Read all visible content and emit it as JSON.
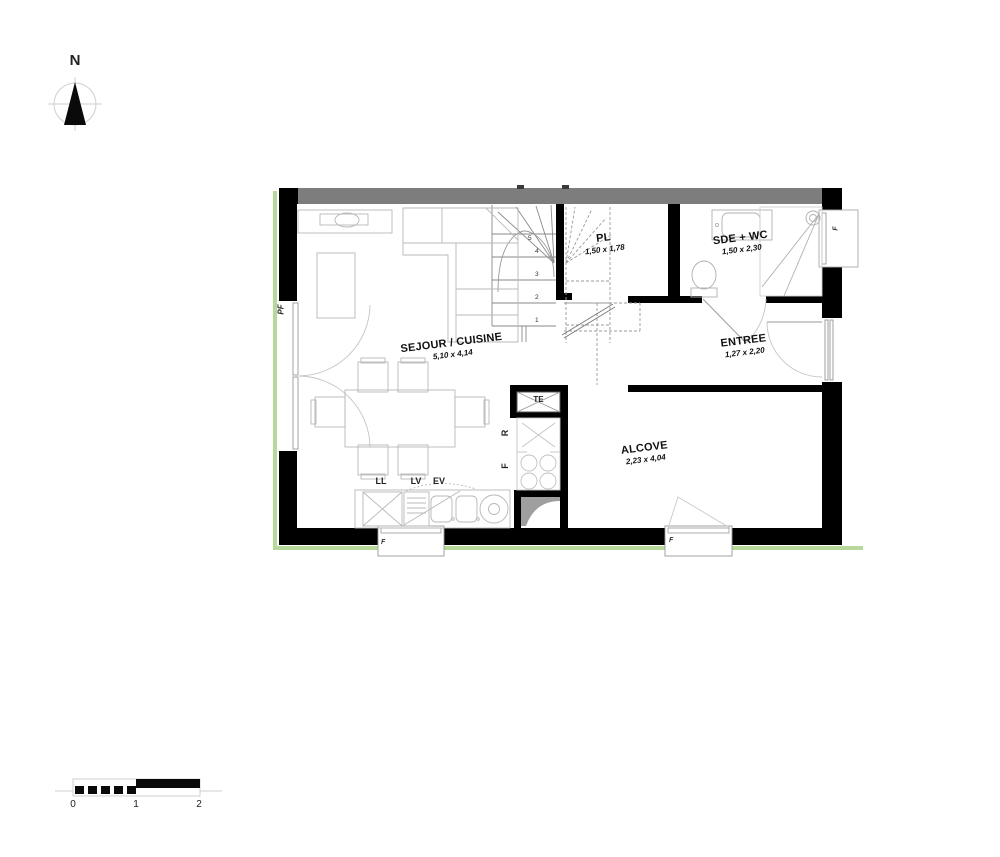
{
  "compass": {
    "label": "N"
  },
  "rooms": [
    {
      "name": "SEJOUR / CUISINE",
      "dims": "5,10 x 4,14"
    },
    {
      "name": "PL",
      "dims": "1,50 x 1,78"
    },
    {
      "name": "SDE + WC",
      "dims": "1,50 x 2,30"
    },
    {
      "name": "ENTREE",
      "dims": "1,27 x 2,20"
    },
    {
      "name": "ALCOVE",
      "dims": "2,23 x 4,04"
    }
  ],
  "labels": {
    "electrical_panel": "TE",
    "refrigerator": "R",
    "oven": "F",
    "washing_machine": "LL",
    "dishwasher": "LV",
    "sink": "EV",
    "french_window": "PF",
    "window": "F"
  },
  "stairs": {
    "steps": [
      "1",
      "2",
      "3",
      "4",
      "5"
    ]
  },
  "scale_bar": {
    "ticks": [
      "0",
      "1",
      "2"
    ]
  },
  "colors": {
    "wall": "#000000",
    "shared_wall": "#7d7d7d",
    "site_line": "#b6d99b",
    "shade": "#9f9f9f"
  }
}
